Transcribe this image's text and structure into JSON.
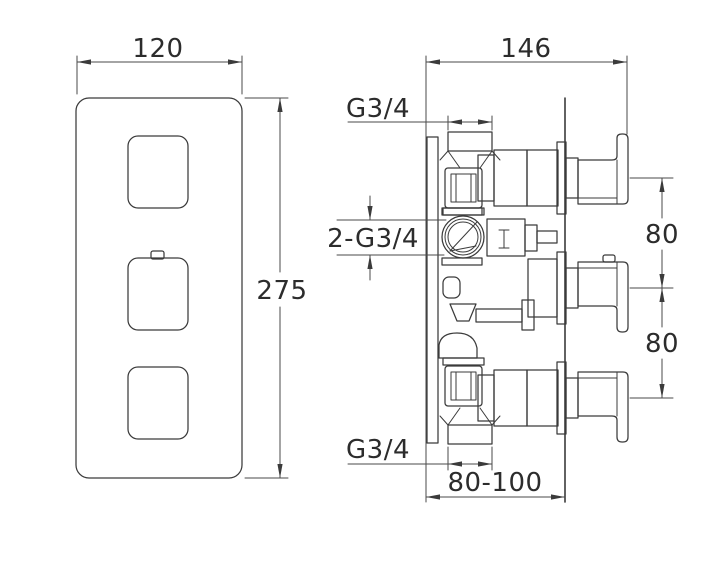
{
  "front_view": {
    "width_dim": "120",
    "height_dim": "275"
  },
  "side_view": {
    "depth_dim": "146",
    "top_inlet_thread": "G3/4",
    "outlet_thread": "2-G3/4",
    "handle_spacing_upper": "80",
    "handle_spacing_lower": "80",
    "bottom_inlet_thread": "G3/4",
    "recess_depth_range": "80-100"
  }
}
